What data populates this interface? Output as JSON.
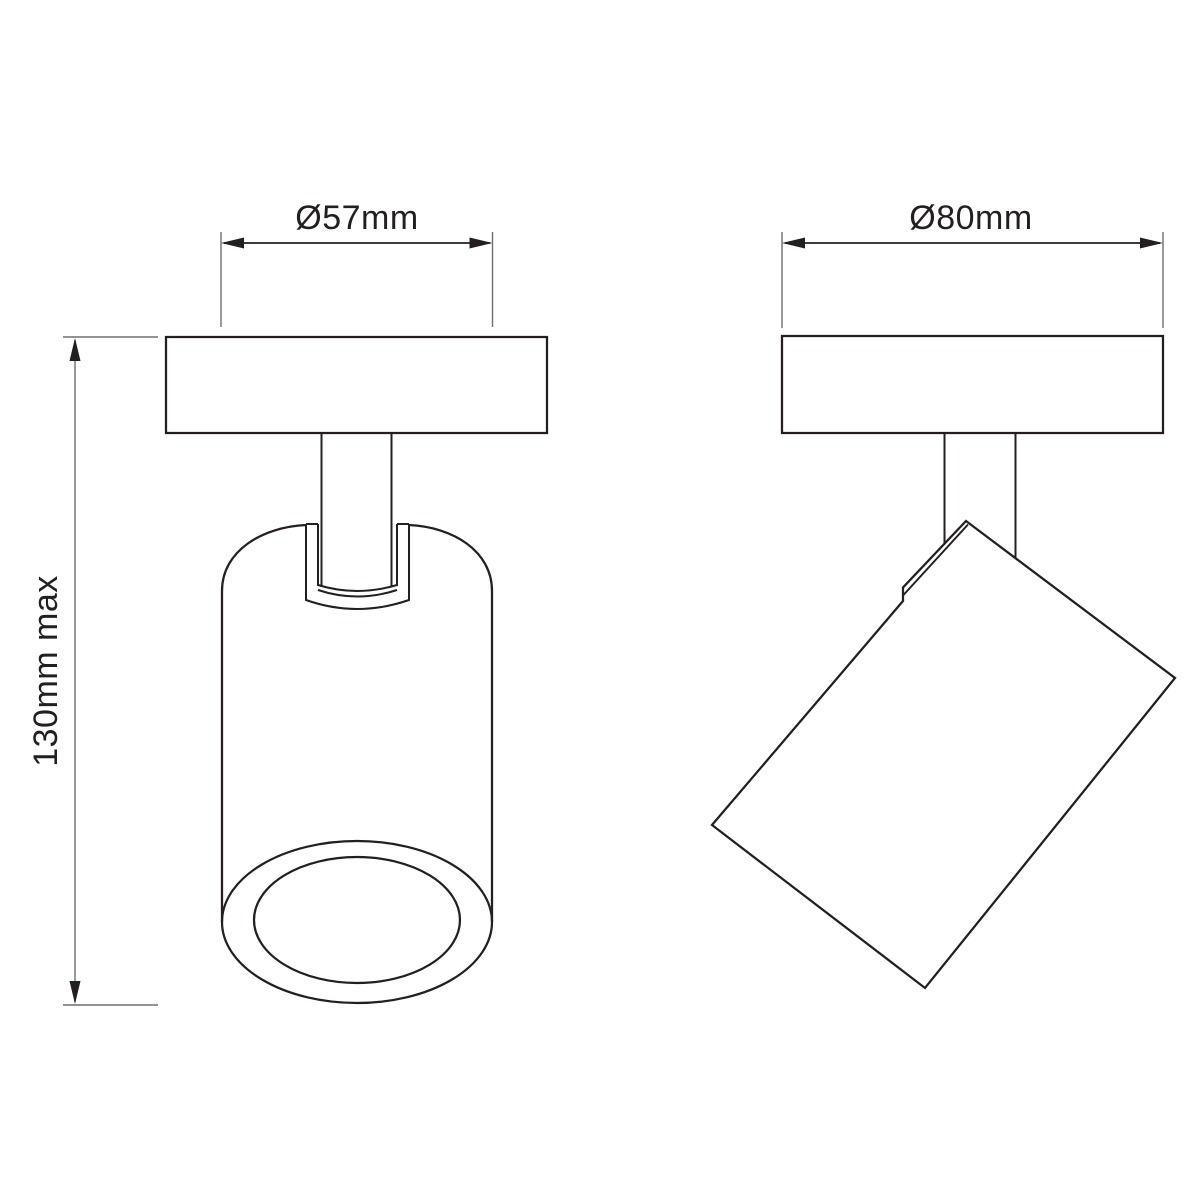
{
  "drawing": {
    "type": "technical-dimension-diagram",
    "subject": "adjustable ceiling spotlight, front and side views",
    "views": {
      "front": {
        "diameter_label": "Ø57mm",
        "height_label": "130mm max"
      },
      "side": {
        "diameter_label": "Ø80mm"
      }
    },
    "colors": {
      "line": "#231f20",
      "dimension_line": "#231f20",
      "extension_line": "#6d6e71",
      "background": "#ffffff"
    }
  }
}
